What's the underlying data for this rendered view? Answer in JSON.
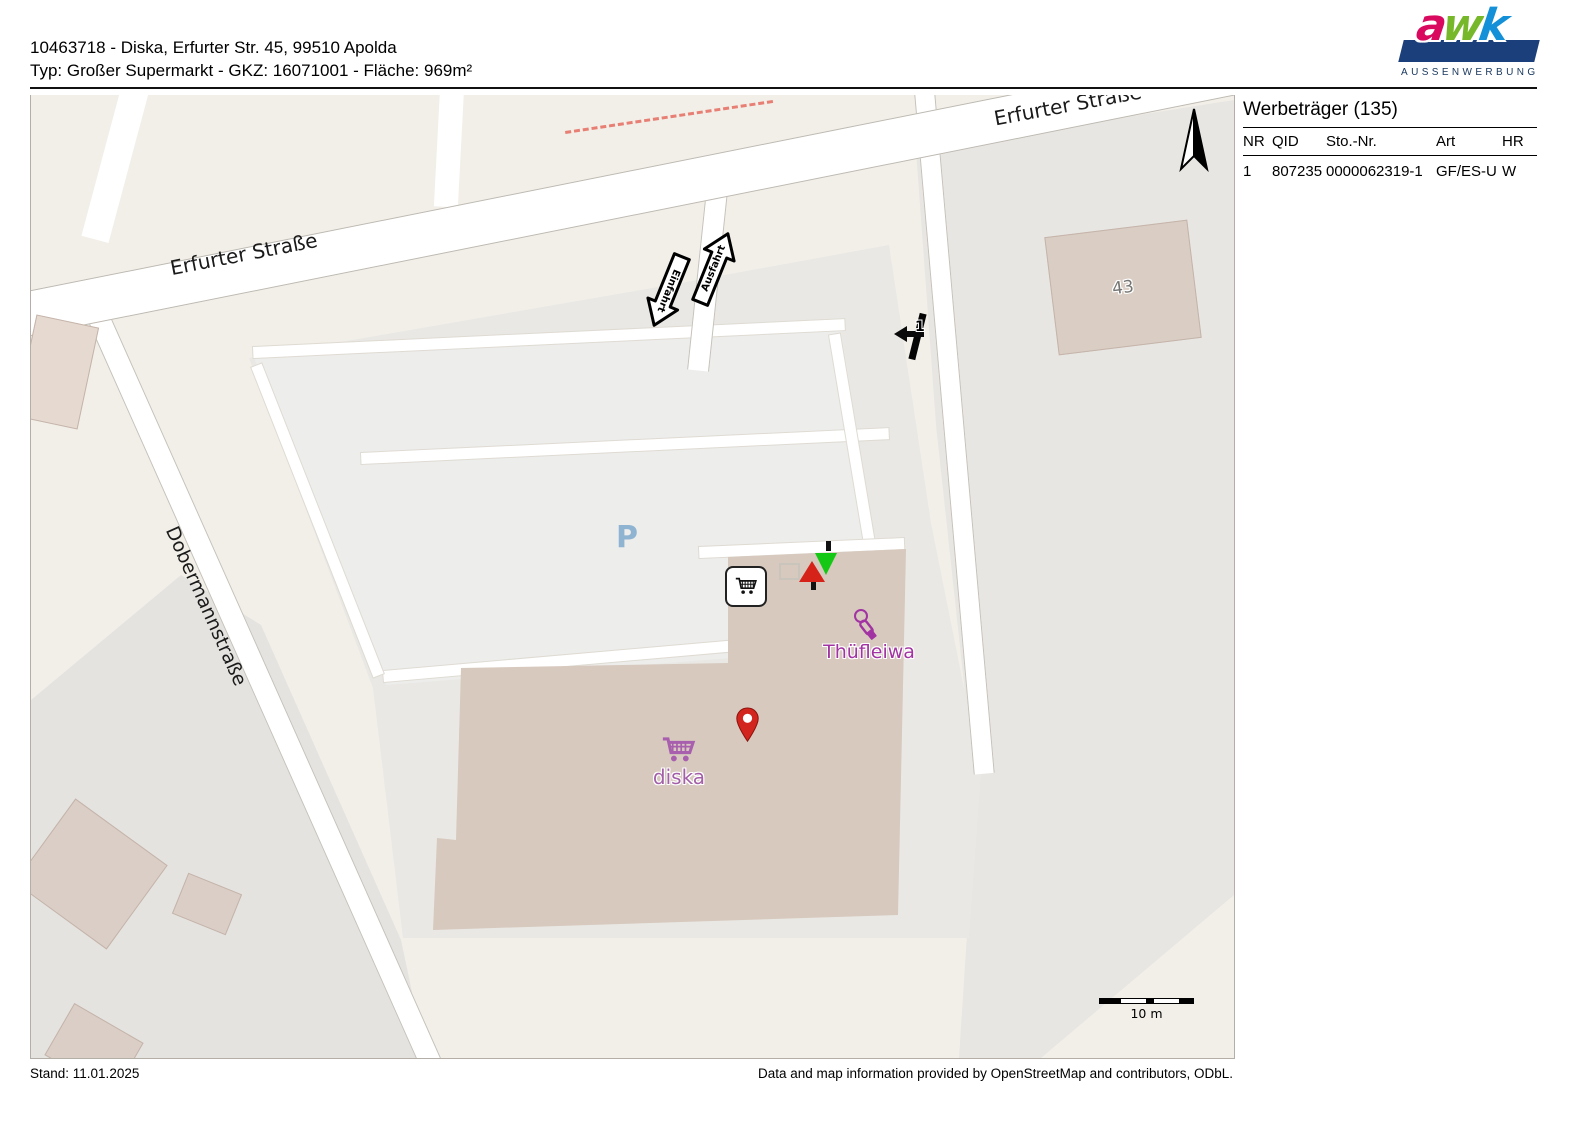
{
  "header": {
    "line1": "10463718 - Diska, Erfurter Str. 45, 99510 Apolda",
    "line2": "Typ: Großer Supermarkt - GKZ: 16071001 - Fläche: 969m²"
  },
  "logo": {
    "letters": [
      "a",
      "w",
      "k"
    ],
    "subtitle": "AUSSENWERBUNG",
    "colors": {
      "a": "#d8095f",
      "w": "#76b82a",
      "k": "#1490d8",
      "bar": "#1b3f7a"
    }
  },
  "panel": {
    "title": "Werbeträger (135)",
    "columns": [
      "NR",
      "QID",
      "Sto.-Nr.",
      "Art",
      "HR"
    ],
    "rows": [
      {
        "nr": "1",
        "qid": "807235",
        "sto_nr": "0000062319-1",
        "art": "GF/ES-U",
        "hr": "W"
      }
    ]
  },
  "map": {
    "streets": {
      "erfurter_left": "Erfurter Straße",
      "erfurter_top": "Erfurter Straße",
      "dobermann": "Dobermannstraße"
    },
    "labels": {
      "parking": "P",
      "house_number": "43",
      "diska": "diska",
      "thuefleiwa": "Thüfleiwa"
    },
    "signs": {
      "ausfahrt": "Ausfahrt",
      "einfahrt": "Einfahrt",
      "werbetraeger_nr": "1"
    },
    "scale_label": "10 m",
    "colors": {
      "background": "#f2efe8",
      "parking_area": "#ededec",
      "building": "#d7c9be",
      "road": "#ffffff",
      "pin_red": "#d2251d",
      "marker_red": "#d6231a",
      "marker_green": "#15c815",
      "poi_purple": "#a233a2",
      "parking_blue": "#8fb4d2",
      "dashed_path": "#e87f74"
    }
  },
  "footer": {
    "stand": "Stand: 11.01.2025",
    "attribution": "Data and map information provided by OpenStreetMap and contributors, ODbL."
  }
}
